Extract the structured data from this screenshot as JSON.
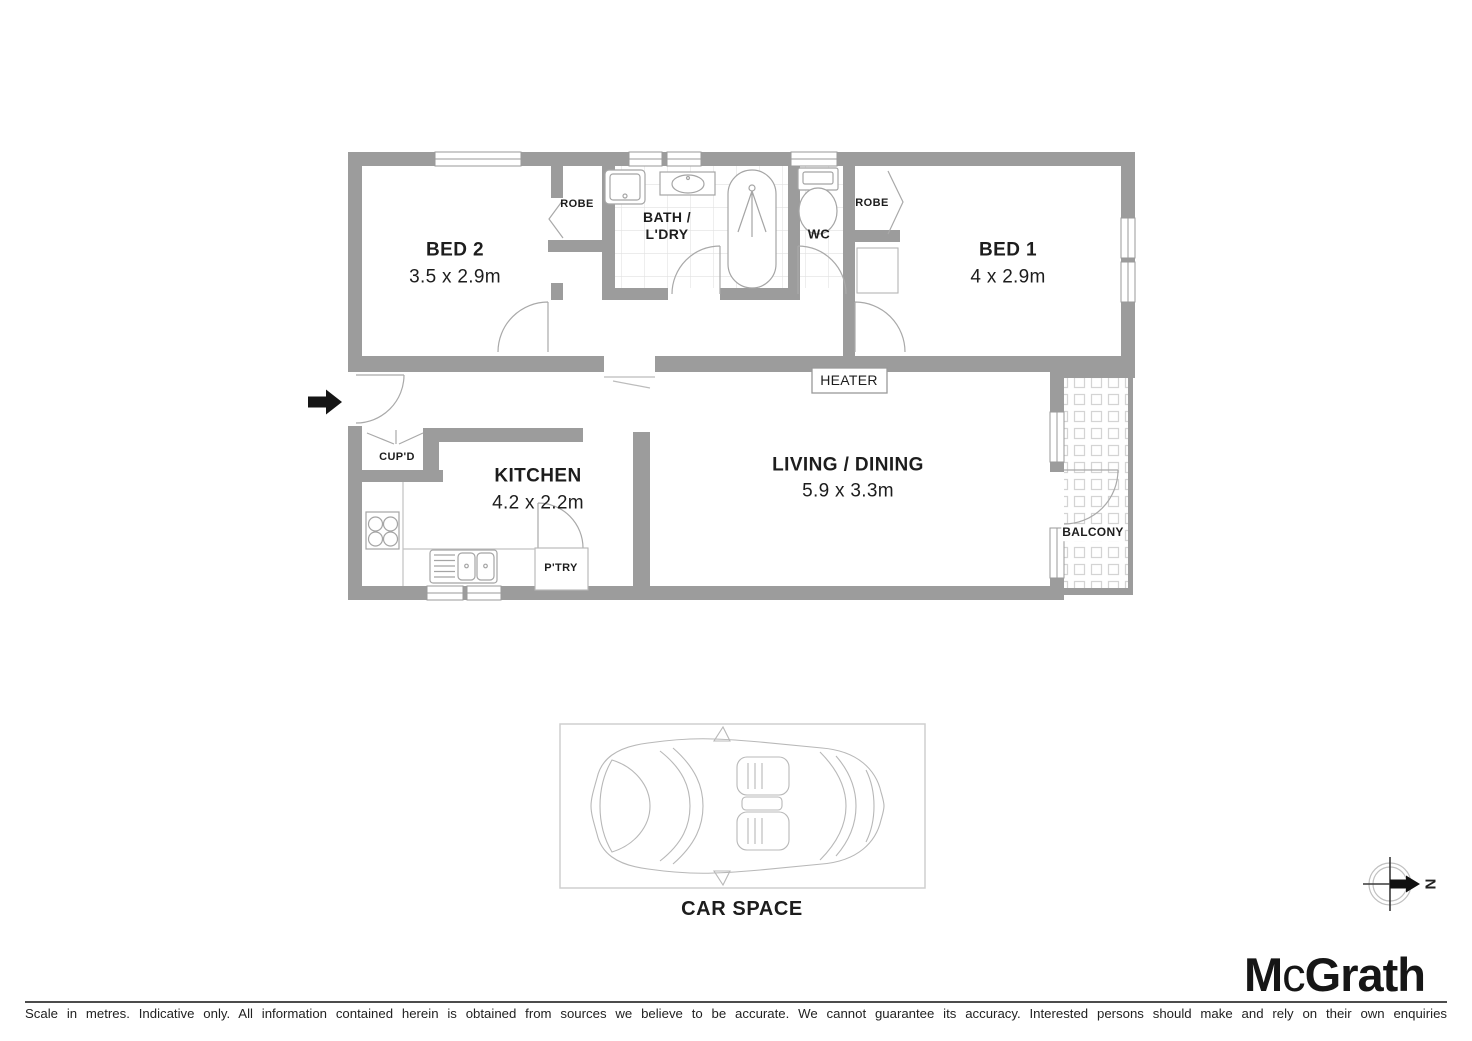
{
  "colors": {
    "wall": "#9c9c9c",
    "fixture_line": "#a5a5a5",
    "text": "#1d1d1d"
  },
  "floorplan": {
    "rooms": {
      "bed2": {
        "name": "BED 2",
        "dims": "3.5 x 2.9m"
      },
      "robe_bed2": {
        "name": "ROBE"
      },
      "bath_laundry": {
        "line1": "BATH /",
        "line2": "L'DRY"
      },
      "wc": {
        "name": "WC"
      },
      "robe_bed1": {
        "name": "ROBE"
      },
      "bed1": {
        "name": "BED 1",
        "dims": "4 x 2.9m"
      },
      "heater": {
        "name": "HEATER"
      },
      "cupboard": {
        "name": "CUP'D"
      },
      "kitchen": {
        "name": "KITCHEN",
        "dims": "4.2 x 2.2m"
      },
      "pantry": {
        "name": "P'TRY"
      },
      "living_dining": {
        "name": "LIVING / DINING",
        "dims": "5.9 x 3.3m"
      },
      "balcony": {
        "name": "BALCONY"
      }
    },
    "car_space": {
      "label": "CAR SPACE"
    },
    "compass": {
      "north": "N"
    }
  },
  "branding": {
    "logo": {
      "part1": "M",
      "part2": "c",
      "part3": "Grath"
    }
  },
  "footer": {
    "disclaimer": "Scale in metres. Indicative only. All information contained herein is obtained from sources we believe to be accurate. We cannot guarantee its accuracy. Interested persons should make and rely on their own enquiries"
  }
}
